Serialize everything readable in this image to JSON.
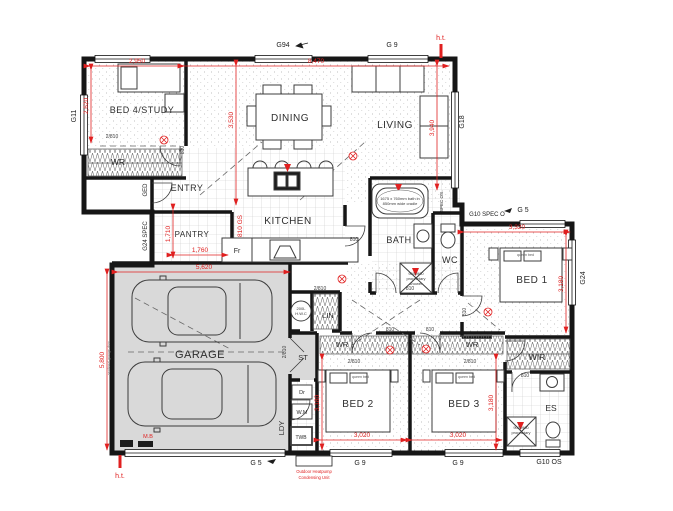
{
  "plan": {
    "rooms": {
      "bed4": "BED 4/STUDY",
      "dining": "DINING",
      "living": "LIVING",
      "entry": "ENTRY",
      "pantry": "PANTRY",
      "kitchen": "KITCHEN",
      "bath": "BATH",
      "wc": "WC",
      "bed1": "BED 1",
      "bed2": "BED 2",
      "bed3": "BED 3",
      "garage": "GARAGE",
      "st": "ST",
      "lin": "LIN",
      "ldy": "LDY",
      "wir": "WIR",
      "es": "ES",
      "wr": "WR"
    },
    "dimensions_mm": {
      "bed4_width": "2,950",
      "main_width": "8,470",
      "bed4_depth": "2,620",
      "dining_depth": "3,530",
      "living_depth": "3,940",
      "pantry_depth": "1,710",
      "pantry_width": "1,760",
      "garage_width": "5,620",
      "garage_depth": "5,800",
      "bed1_width": "3,320",
      "bed1_depth": "3,180",
      "bed2_width": "3,020",
      "bed2_depth": "3,180",
      "bed3_width": "3,020",
      "bed3_depth": "3,180"
    },
    "doors": {
      "single": "810",
      "double": "2/810",
      "garage_side": "810 GS"
    },
    "glazing": {
      "g94": "G94",
      "g9": "G 9",
      "g11": "G11",
      "g18": "G18",
      "ged": "GED",
      "g24_spec": "G24 SPEC",
      "g10_spec_o": "G10 SPEC O",
      "g5": "G 5",
      "g24": "G24",
      "g10_os": "G10 OS",
      "spec_os": "SPEC OS"
    },
    "fixtures": {
      "fridge": "Fr",
      "dryer": "Dr",
      "washing_machine": "W.M",
      "tub": "TWB",
      "hwc_line1": "200L",
      "hwc_line2": "H.W.C",
      "queen_bed": "queen bed",
      "bath_note_line1": "1675 x 760mm bath in",
      "bath_note_line2": "850mm wide cradle",
      "shower_note_line1": "900x900",
      "shower_note_line2": "proprietary",
      "shower_note_line3": "shower",
      "garage_door_note": "sectional garage door"
    },
    "annotations": {
      "ht": "h.t.",
      "mb": "M.B",
      "heatpump_line1": "Outdoor Heatpump",
      "heatpump_line2": "Condensing Unit"
    },
    "colors": {
      "dimension_red": "#e02020",
      "wall": "#161616",
      "garage_floor": "#d9d9d9"
    }
  }
}
